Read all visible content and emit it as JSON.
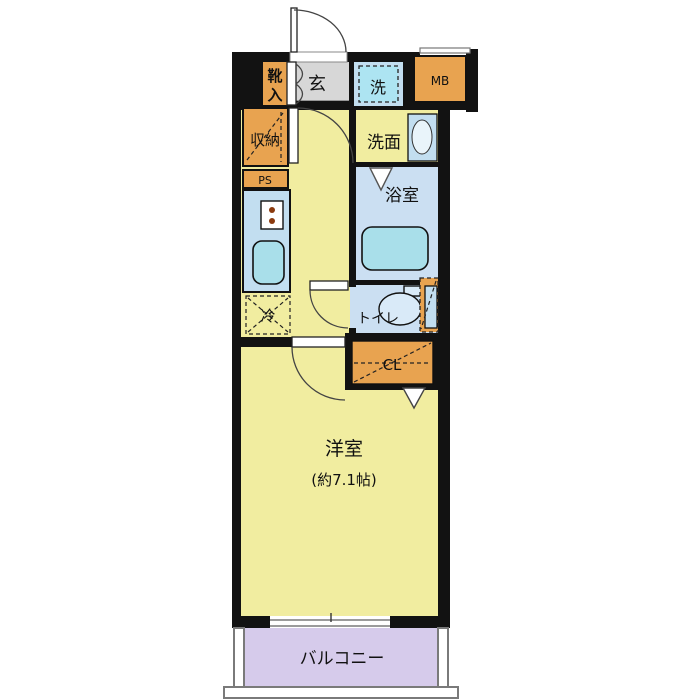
{
  "colors": {
    "wall": "#121212",
    "floor_yellow": "#F1EDA0",
    "tile_gray": "#D7D7D7",
    "wet_blue": "#CBDFF2",
    "fixture_blue": "#C2DEF0",
    "cyan": "#A9DFEA",
    "washer_inner": "#ADE4F2",
    "orange": "#E8A350",
    "balcony_purple": "#D6CBEB",
    "rail_gray": "#7A7A7A",
    "dot_brown": "#8B3A0E"
  },
  "labels": {
    "entrance": "玄",
    "shoe_box_1": "靴",
    "shoe_box_2": "入",
    "washer": "洗",
    "meter_box": "MB",
    "storage": "収納",
    "pipe_space": "PS",
    "washroom": "洗面",
    "bathroom": "浴室",
    "refrigerator": "冷",
    "toilet": "トイレ",
    "closet": "CL",
    "main_room": "洋室",
    "main_room_size": "(約7.1帖)",
    "balcony": "バルコニー"
  }
}
